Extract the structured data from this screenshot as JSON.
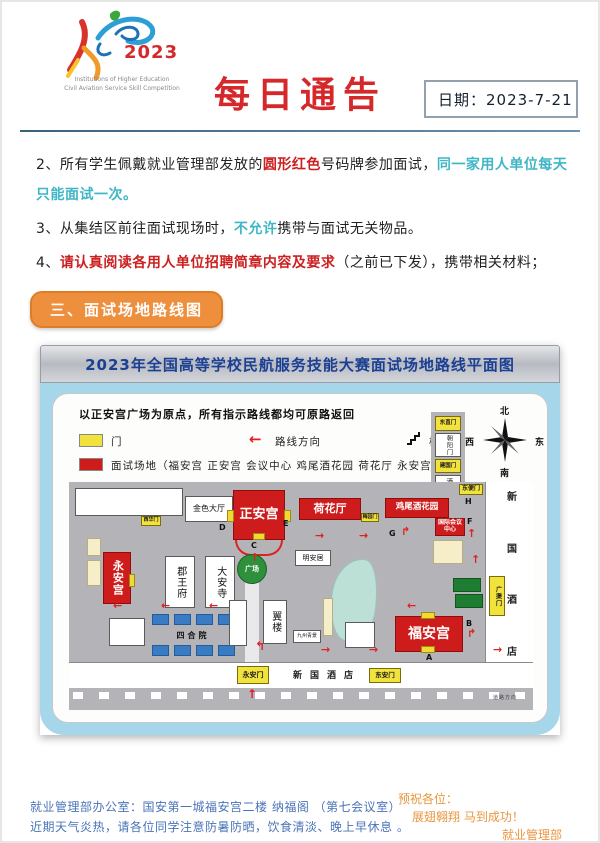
{
  "header": {
    "logo_year": "2023",
    "logo_caption_line1": "Institutions of Higher Education",
    "logo_caption_line2": "Civil Aviation Service Skill Competition",
    "title": "每日通告",
    "date_label": "日期：2023-7-21"
  },
  "notices": {
    "item2_prefix": "2、所有学生佩戴就业管理部发放的",
    "item2_red": "圆形红色",
    "item2_mid": "号码牌参加面试，",
    "item2_teal": "同一家用人单位每天只能面试一次。",
    "item3_prefix": "3、从集结区前往面试现场时，",
    "item3_teal": "不允许",
    "item3_suffix": "携带与面试无关物品。",
    "item4_prefix": "4、",
    "item4_red": "请认真阅读各用人单位招聘简章内容及要求",
    "item4_suffix": "（之前已下发），携带相关材料；"
  },
  "section_badge": "三、面试场地路线图",
  "map": {
    "title": "2023年全国高等学校民航服务技能大赛面试场地路线平面图",
    "note": "以正安宫广场为原点，所有指示路线都均可原路返回",
    "legend": {
      "gate": "门",
      "direction": "路线方向",
      "stairs": "楼梯",
      "venues": "面试场地（福安宫 正安宫 会议中心 鸡尾酒花园 荷花厅 永安宫）"
    },
    "compass": {
      "n": "北",
      "s": "南",
      "w": "西",
      "e": "东"
    },
    "labels": {
      "jinse": "金色大厅",
      "zhengangong": "正安宫",
      "hehuating": "荷花厅",
      "jiweijiu": "鸡尾酒花园",
      "guoji": "国际会议中心",
      "dongbianmen": "东便门",
      "dongzhimen": "东直门",
      "chaoyangmen": "朝阳门",
      "jianguomen": "建国门",
      "jiudian": "酒店",
      "yonganggong": "永安宫",
      "junwangfu": "郡王府",
      "daansi": "大安寺",
      "xihuamen": "西华门",
      "meiyuanmen": "梅园门",
      "guangchang": "广场",
      "minganju": "明安居",
      "siheyuan": "四合院",
      "yilou": "翼楼",
      "jiuzhou": "九州青景",
      "fuangong": "福安宫",
      "guangqumen": "广渠门",
      "hotel_v1": "新",
      "hotel_v2": "国",
      "hotel_v3": "酒",
      "hotel_v4": "店",
      "hotel_bottom": "新国酒店",
      "yonganmen": "永安门",
      "donganmen": "东安门",
      "road_note": "道路方向"
    },
    "letters": {
      "a": "A",
      "b": "B",
      "c": "C",
      "d": "D",
      "e": "E",
      "f": "F",
      "g": "G",
      "h": "H"
    }
  },
  "icons": {
    "arrow_left": "←",
    "arrow_right": "→",
    "arrow_up": "↑",
    "turn_right_up": "↱",
    "turn_left_up": "↰"
  },
  "footer": {
    "left_line1": "就业管理部办公室：国安第一城福安宫二楼 纳福阁 （第七会议室）",
    "left_line2": "近期天气炎热，请各位同学注意防暑防晒，饮食清淡、晚上早休息 。",
    "right_line1": "预祝各位：",
    "right_line2": "展翅翱翔 马到成功！",
    "right_line3": "就业管理部"
  },
  "colors": {
    "title_red": "#d5282a",
    "highlight_red": "#cc2020",
    "highlight_teal": "#3fb6c6",
    "badge_orange": "#ee8f3e",
    "map_title_blue": "#1b3f92",
    "venue_red": "#ce1c1c",
    "gate_yellow": "#f2e33c",
    "map_bg_blue": "#a6d6ea",
    "footer_blue": "#4a74b8",
    "footer_orange": "#e8963f"
  }
}
